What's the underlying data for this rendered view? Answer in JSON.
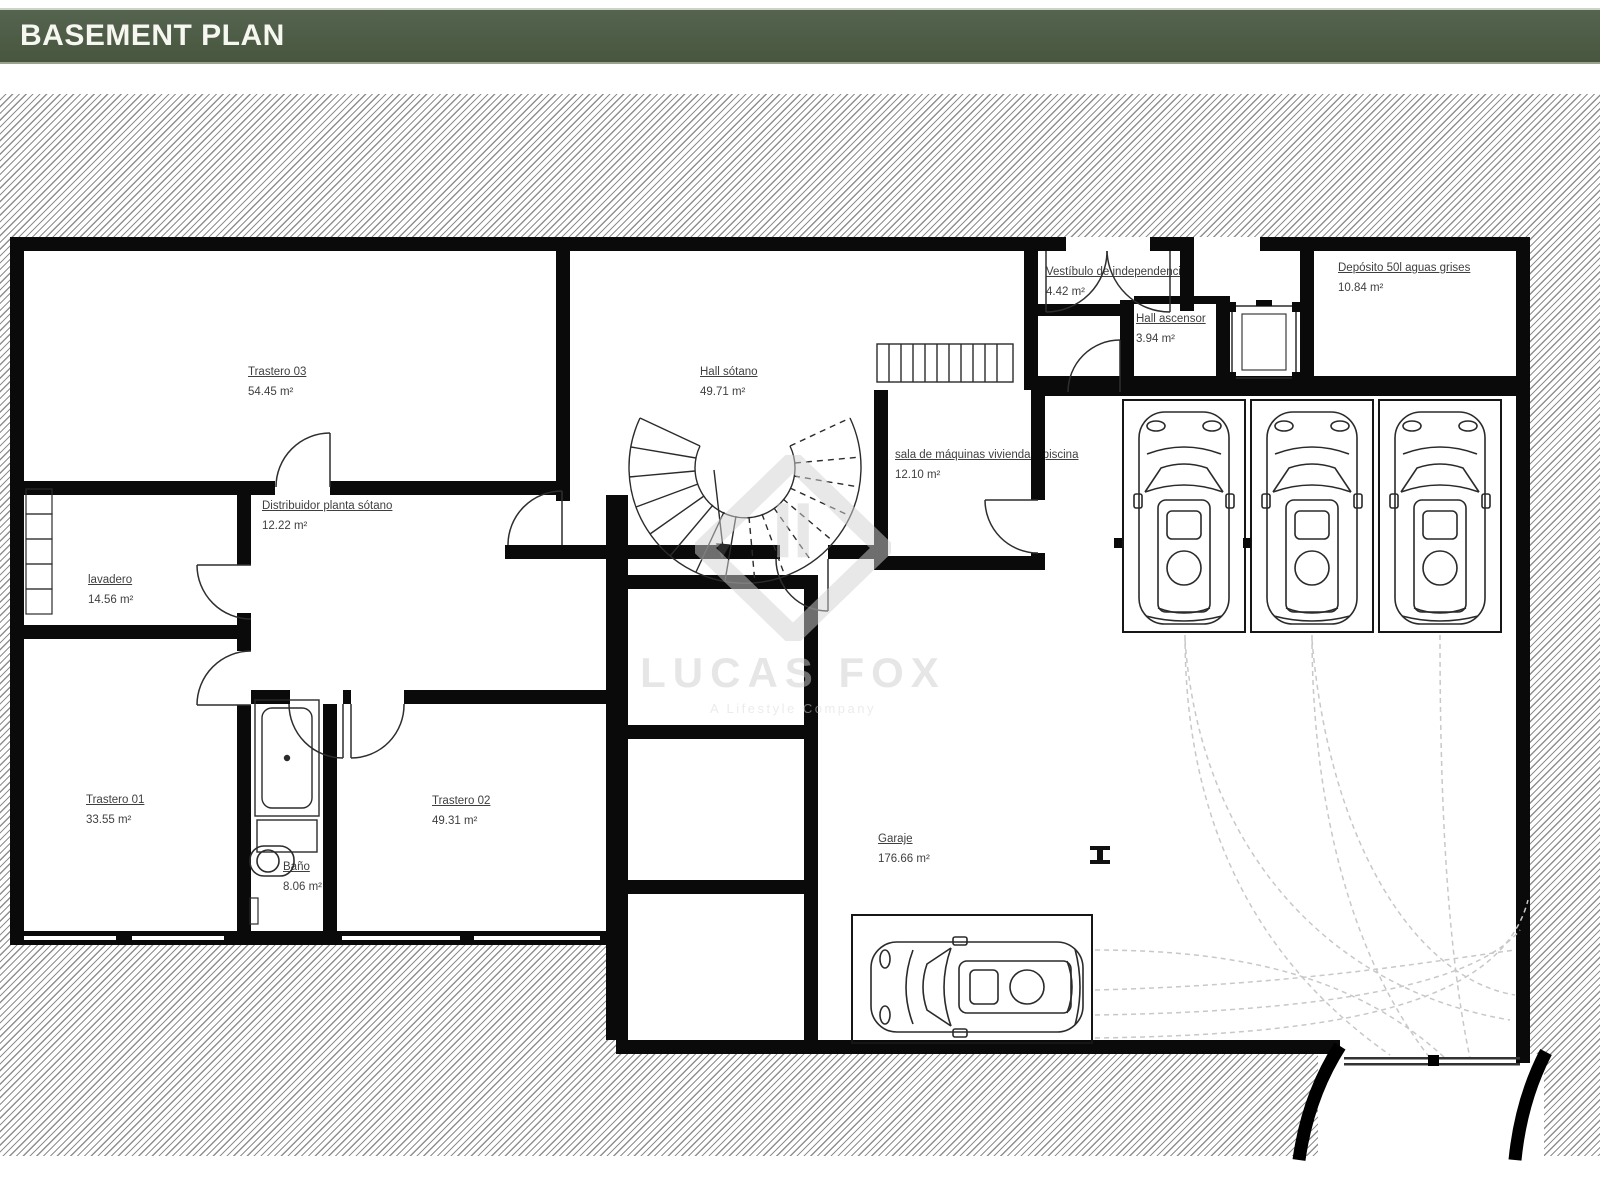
{
  "header": {
    "title": "BASEMENT PLAN",
    "bar_color": "#4f5d4a"
  },
  "watermark": {
    "brand": "LUCAS FOX",
    "tagline": "A Lifestyle Company"
  },
  "rooms": [
    {
      "name": "Trastero 03",
      "area": "54.45 m²"
    },
    {
      "name": "Hall sótano",
      "area": "49.71 m²"
    },
    {
      "name": "Vestíbulo de independencia",
      "area": "4.42 m²"
    },
    {
      "name": "Hall ascensor",
      "area": "3.94 m²"
    },
    {
      "name": "Depósito 50l aguas grises",
      "area": "10.84 m²"
    },
    {
      "name": "sala de máquinas vivienda y piscina",
      "area": "12.10 m²"
    },
    {
      "name": "Distribuidor planta sótano",
      "area": "12.22 m²"
    },
    {
      "name": "lavadero",
      "area": "14.56 m²"
    },
    {
      "name": "Trastero 01",
      "area": "33.55 m²"
    },
    {
      "name": "Trastero 02",
      "area": "49.31 m²"
    },
    {
      "name": "Baño",
      "area": "8.06 m²"
    },
    {
      "name": "Garaje",
      "area": "176.66 m²"
    }
  ]
}
